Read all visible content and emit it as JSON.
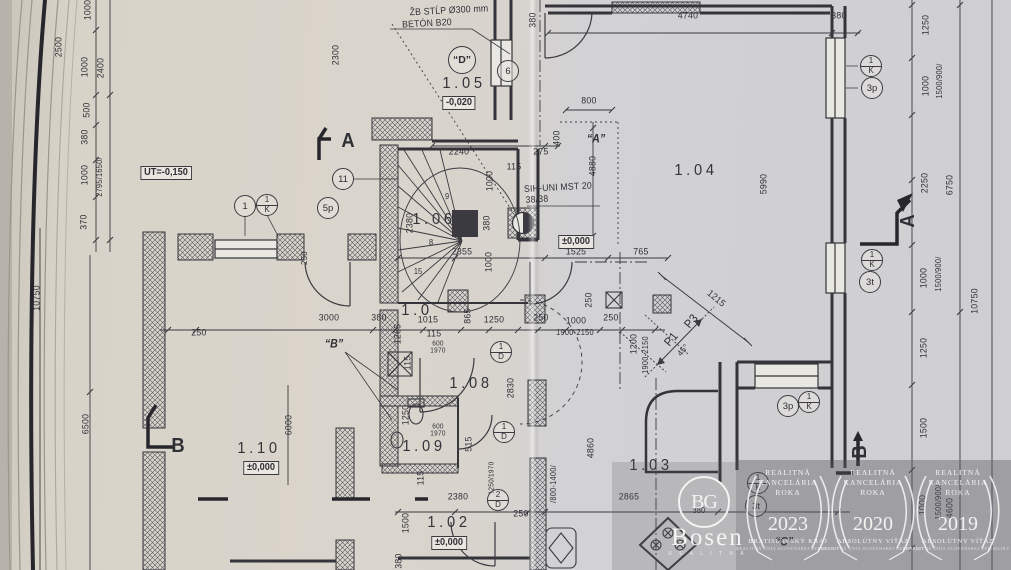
{
  "colors": {
    "ink": "#2f2f36",
    "paper_warm": "#d8d3ca",
    "paper_cool": "#d1d1d4",
    "page_edge": "#b7b3ab",
    "hatch": "#55555c",
    "watermark_white": "#f4f4f2",
    "overlay": "rgba(84,84,92,0.40)"
  },
  "notes": {
    "column": [
      "ŽB STĹP Ø300 mm",
      "BETÓN B20"
    ],
    "sill": [
      "SIH-UNI MST 20",
      "38/38"
    ]
  },
  "rooms": [
    {
      "t": "1.05",
      "x": 464,
      "y": 84
    },
    {
      "t": "1.04",
      "x": 696,
      "y": 171
    },
    {
      "t": "1.06",
      "x": 434,
      "y": 220
    },
    {
      "t": "1.0",
      "x": 417,
      "y": 311
    },
    {
      "t": "1.08",
      "x": 471,
      "y": 384
    },
    {
      "t": "1.09",
      "x": 424,
      "y": 447
    },
    {
      "t": "1.10",
      "x": 259,
      "y": 449
    },
    {
      "t": "1.02",
      "x": 449,
      "y": 523
    },
    {
      "t": "1.03",
      "x": 651,
      "y": 466
    }
  ],
  "levels": [
    {
      "t": "UT=-0,150",
      "x": 166,
      "y": 173
    },
    {
      "t": "-0,020",
      "x": 459,
      "y": 103
    },
    {
      "t": "±0,000",
      "x": 576,
      "y": 242
    },
    {
      "t": "±0,000",
      "x": 261,
      "y": 468
    },
    {
      "t": "±0,000",
      "x": 449,
      "y": 543
    }
  ],
  "dims": [
    {
      "t": "1000",
      "x": 88,
      "y": 10,
      "r": -90
    },
    {
      "t": "2500",
      "x": 59,
      "y": 47,
      "r": -90
    },
    {
      "t": "1000",
      "x": 85,
      "y": 67,
      "r": -90
    },
    {
      "t": "2400",
      "x": 101,
      "y": 68,
      "r": -90
    },
    {
      "t": "500",
      "x": 87,
      "y": 110,
      "r": -90
    },
    {
      "t": "380",
      "x": 85,
      "y": 137,
      "r": -90
    },
    {
      "t": "1000",
      "x": 85,
      "y": 175,
      "r": -90
    },
    {
      "t": "2795/1650/",
      "x": 100,
      "y": 177,
      "r": -90,
      "s": 8
    },
    {
      "t": "370",
      "x": 84,
      "y": 222,
      "r": -90
    },
    {
      "t": "10750",
      "x": 37,
      "y": 298,
      "r": -90
    },
    {
      "t": "6500",
      "x": 86,
      "y": 424,
      "r": -90
    },
    {
      "t": "2300",
      "x": 336,
      "y": 55,
      "r": -90
    },
    {
      "t": "380",
      "x": 533,
      "y": 20,
      "r": -90
    },
    {
      "t": "4740",
      "x": 688,
      "y": 16
    },
    {
      "t": "380",
      "x": 839,
      "y": 16
    },
    {
      "t": "800",
      "x": 589,
      "y": 101
    },
    {
      "t": "400",
      "x": 557,
      "y": 138,
      "r": -90
    },
    {
      "t": "2240",
      "x": 459,
      "y": 152
    },
    {
      "t": "275",
      "x": 541,
      "y": 152
    },
    {
      "t": "115",
      "x": 514,
      "y": 167
    },
    {
      "t": "1000",
      "x": 490,
      "y": 181,
      "r": -90
    },
    {
      "t": "4880",
      "x": 593,
      "y": 166,
      "r": -90
    },
    {
      "t": "5990",
      "x": 764,
      "y": 184,
      "r": -90
    },
    {
      "t": "2380",
      "x": 410,
      "y": 223,
      "r": -90
    },
    {
      "t": "380",
      "x": 487,
      "y": 223,
      "r": -90
    },
    {
      "t": "1000",
      "x": 489,
      "y": 262,
      "r": -90
    },
    {
      "t": "2355",
      "x": 462,
      "y": 252
    },
    {
      "t": "1525",
      "x": 576,
      "y": 252
    },
    {
      "t": "765",
      "x": 641,
      "y": 252
    },
    {
      "t": "250",
      "x": 304,
      "y": 258,
      "r": -90,
      "s": 8.5
    },
    {
      "t": "250",
      "x": 199,
      "y": 333
    },
    {
      "t": "3000",
      "x": 329,
      "y": 318
    },
    {
      "t": "380",
      "x": 379,
      "y": 318
    },
    {
      "t": "1265",
      "x": 398,
      "y": 334,
      "r": -90
    },
    {
      "t": "1015",
      "x": 428,
      "y": 320
    },
    {
      "t": "115",
      "x": 434,
      "y": 334
    },
    {
      "t": "600",
      "x": 438,
      "y": 344,
      "s": 7
    },
    {
      "t": "1970",
      "x": 438,
      "y": 351,
      "s": 7
    },
    {
      "t": "115",
      "x": 408,
      "y": 363,
      "r": -90
    },
    {
      "t": "865",
      "x": 468,
      "y": 316,
      "r": -90
    },
    {
      "t": "1250",
      "x": 494,
      "y": 320
    },
    {
      "t": "250",
      "x": 541,
      "y": 318
    },
    {
      "t": "1000",
      "x": 576,
      "y": 321
    },
    {
      "t": "1900-2150",
      "x": 575,
      "y": 333,
      "s": 8
    },
    {
      "t": "250",
      "x": 611,
      "y": 318
    },
    {
      "t": "250",
      "x": 589,
      "y": 300,
      "r": -90
    },
    {
      "t": "1200",
      "x": 634,
      "y": 344,
      "r": -90
    },
    {
      "t": "1900-2150",
      "x": 646,
      "y": 355,
      "r": -90,
      "s": 8
    },
    {
      "t": "1215",
      "x": 716,
      "y": 299,
      "r": 40
    },
    {
      "t": "P1",
      "x": 671,
      "y": 339,
      "r": -50,
      "s": 12
    },
    {
      "t": "P3",
      "x": 691,
      "y": 321,
      "r": -50,
      "s": 12
    },
    {
      "t": "45°",
      "x": 683,
      "y": 350,
      "r": -50,
      "s": 8.5
    },
    {
      "t": "2830",
      "x": 511,
      "y": 388,
      "r": -90
    },
    {
      "t": "1250",
      "x": 406,
      "y": 415,
      "r": -90
    },
    {
      "t": "600",
      "x": 438,
      "y": 427,
      "s": 7
    },
    {
      "t": "1970",
      "x": 438,
      "y": 434,
      "s": 7
    },
    {
      "t": "515",
      "x": 469,
      "y": 444,
      "r": -90
    },
    {
      "t": "4860",
      "x": 591,
      "y": 448,
      "r": -90
    },
    {
      "t": "6000",
      "x": 289,
      "y": 425,
      "r": -90
    },
    {
      "t": "115",
      "x": 421,
      "y": 478,
      "r": -90
    },
    {
      "t": "1250/1970",
      "x": 492,
      "y": 478,
      "r": -90,
      "s": 7
    },
    {
      "t": "/800-1400/",
      "x": 554,
      "y": 484,
      "r": -90,
      "s": 8
    },
    {
      "t": "2380",
      "x": 458,
      "y": 497
    },
    {
      "t": "250",
      "x": 521,
      "y": 514
    },
    {
      "t": "2865",
      "x": 629,
      "y": 497
    },
    {
      "t": "380",
      "x": 699,
      "y": 511,
      "s": 8
    },
    {
      "t": "1500",
      "x": 406,
      "y": 523,
      "r": -90
    },
    {
      "t": "380",
      "x": 399,
      "y": 561,
      "r": -90
    },
    {
      "t": "1250",
      "x": 926,
      "y": 25,
      "r": -90
    },
    {
      "t": "1500/900/",
      "x": 940,
      "y": 81,
      "r": -90,
      "s": 8
    },
    {
      "t": "1000",
      "x": 926,
      "y": 86,
      "r": -90
    },
    {
      "t": "2250",
      "x": 925,
      "y": 183,
      "r": -90
    },
    {
      "t": "6750",
      "x": 950,
      "y": 185,
      "r": -90
    },
    {
      "t": "1500/900/",
      "x": 939,
      "y": 274,
      "r": -90,
      "s": 8
    },
    {
      "t": "1000",
      "x": 924,
      "y": 278,
      "r": -90
    },
    {
      "t": "10750",
      "x": 975,
      "y": 301,
      "r": -90
    },
    {
      "t": "1250",
      "x": 924,
      "y": 348,
      "r": -90
    },
    {
      "t": "1500",
      "x": 924,
      "y": 428,
      "r": -90
    },
    {
      "t": "1500/900/",
      "x": 939,
      "y": 502,
      "r": -90,
      "s": 8
    },
    {
      "t": "1000",
      "x": 923,
      "y": 505,
      "r": -90
    },
    {
      "t": "4600",
      "x": 950,
      "y": 508,
      "r": -90
    }
  ],
  "refs": [
    {
      "t": "“A”",
      "x": 596,
      "y": 140
    },
    {
      "t": "“B”",
      "x": 334,
      "y": 345
    },
    {
      "t": "“C”",
      "x": 784,
      "y": 543
    }
  ],
  "sections": [
    {
      "t": "A",
      "x": 348,
      "y": 141,
      "r": 0
    },
    {
      "t": "A",
      "x": 908,
      "y": 221,
      "r": -90
    },
    {
      "t": "B",
      "x": 178,
      "y": 446,
      "r": 0
    },
    {
      "t": "B",
      "x": 860,
      "y": 452,
      "r": -90
    }
  ],
  "stairs": [
    {
      "t": "9",
      "x": 447,
      "y": 197
    },
    {
      "t": "8",
      "x": 431,
      "y": 243
    },
    {
      "t": "15",
      "x": 418,
      "y": 272
    }
  ],
  "markers": {
    "circled": [
      {
        "t": "“D”",
        "x": 462,
        "y": 60
      }
    ],
    "plain": [
      {
        "t": "1",
        "x": 245,
        "y": 206
      },
      {
        "t": "5p",
        "x": 328,
        "y": 208
      },
      {
        "t": "11",
        "x": 343,
        "y": 179
      },
      {
        "t": "6",
        "x": 508,
        "y": 71
      },
      {
        "t": "3p",
        "x": 872,
        "y": 88
      },
      {
        "t": "3t",
        "x": 870,
        "y": 282
      },
      {
        "t": "3p",
        "x": 788,
        "y": 406
      },
      {
        "t": "3t",
        "x": 756,
        "y": 506
      }
    ],
    "split": [
      {
        "a": "1",
        "b": "K",
        "x": 267,
        "y": 205
      },
      {
        "a": "1",
        "b": "K",
        "x": 871,
        "y": 66
      },
      {
        "a": "1",
        "b": "K",
        "x": 872,
        "y": 260
      },
      {
        "a": "1",
        "b": "K",
        "x": 809,
        "y": 402
      },
      {
        "a": "1",
        "b": "K",
        "x": 758,
        "y": 483
      },
      {
        "a": "1",
        "b": "D",
        "x": 501,
        "y": 352
      },
      {
        "a": "1",
        "b": "D",
        "x": 504,
        "y": 432
      },
      {
        "a": "2",
        "b": "D",
        "x": 498,
        "y": 500
      }
    ]
  },
  "watermark": {
    "logo_monogram": "BG",
    "logo_text": "Bosen",
    "logo_tagline": "R E A L I T N Á",
    "badge_title": [
      "REALITNÁ",
      "KANCELÁRIA",
      "ROKA"
    ],
    "badges": [
      {
        "year": "2023",
        "subtitle": "BRATISLAVSKÝ KRAJ",
        "org": "REALITNÁ ÚNIA SLOVENSKEJ REPUBLIKY",
        "x": 788
      },
      {
        "year": "2020",
        "subtitle": "ABSOLÚTNY VÍŤAZ",
        "org": "REALITNÁ ÚNIA SLOVENSKEJ REPUBLIKY",
        "x": 873
      },
      {
        "year": "2019",
        "subtitle": "ABSOLÚTNY VÍŤAZ",
        "org": "REALITNÁ ÚNIA SLOVENSKEJ REPUBLIKY",
        "x": 958
      }
    ]
  }
}
